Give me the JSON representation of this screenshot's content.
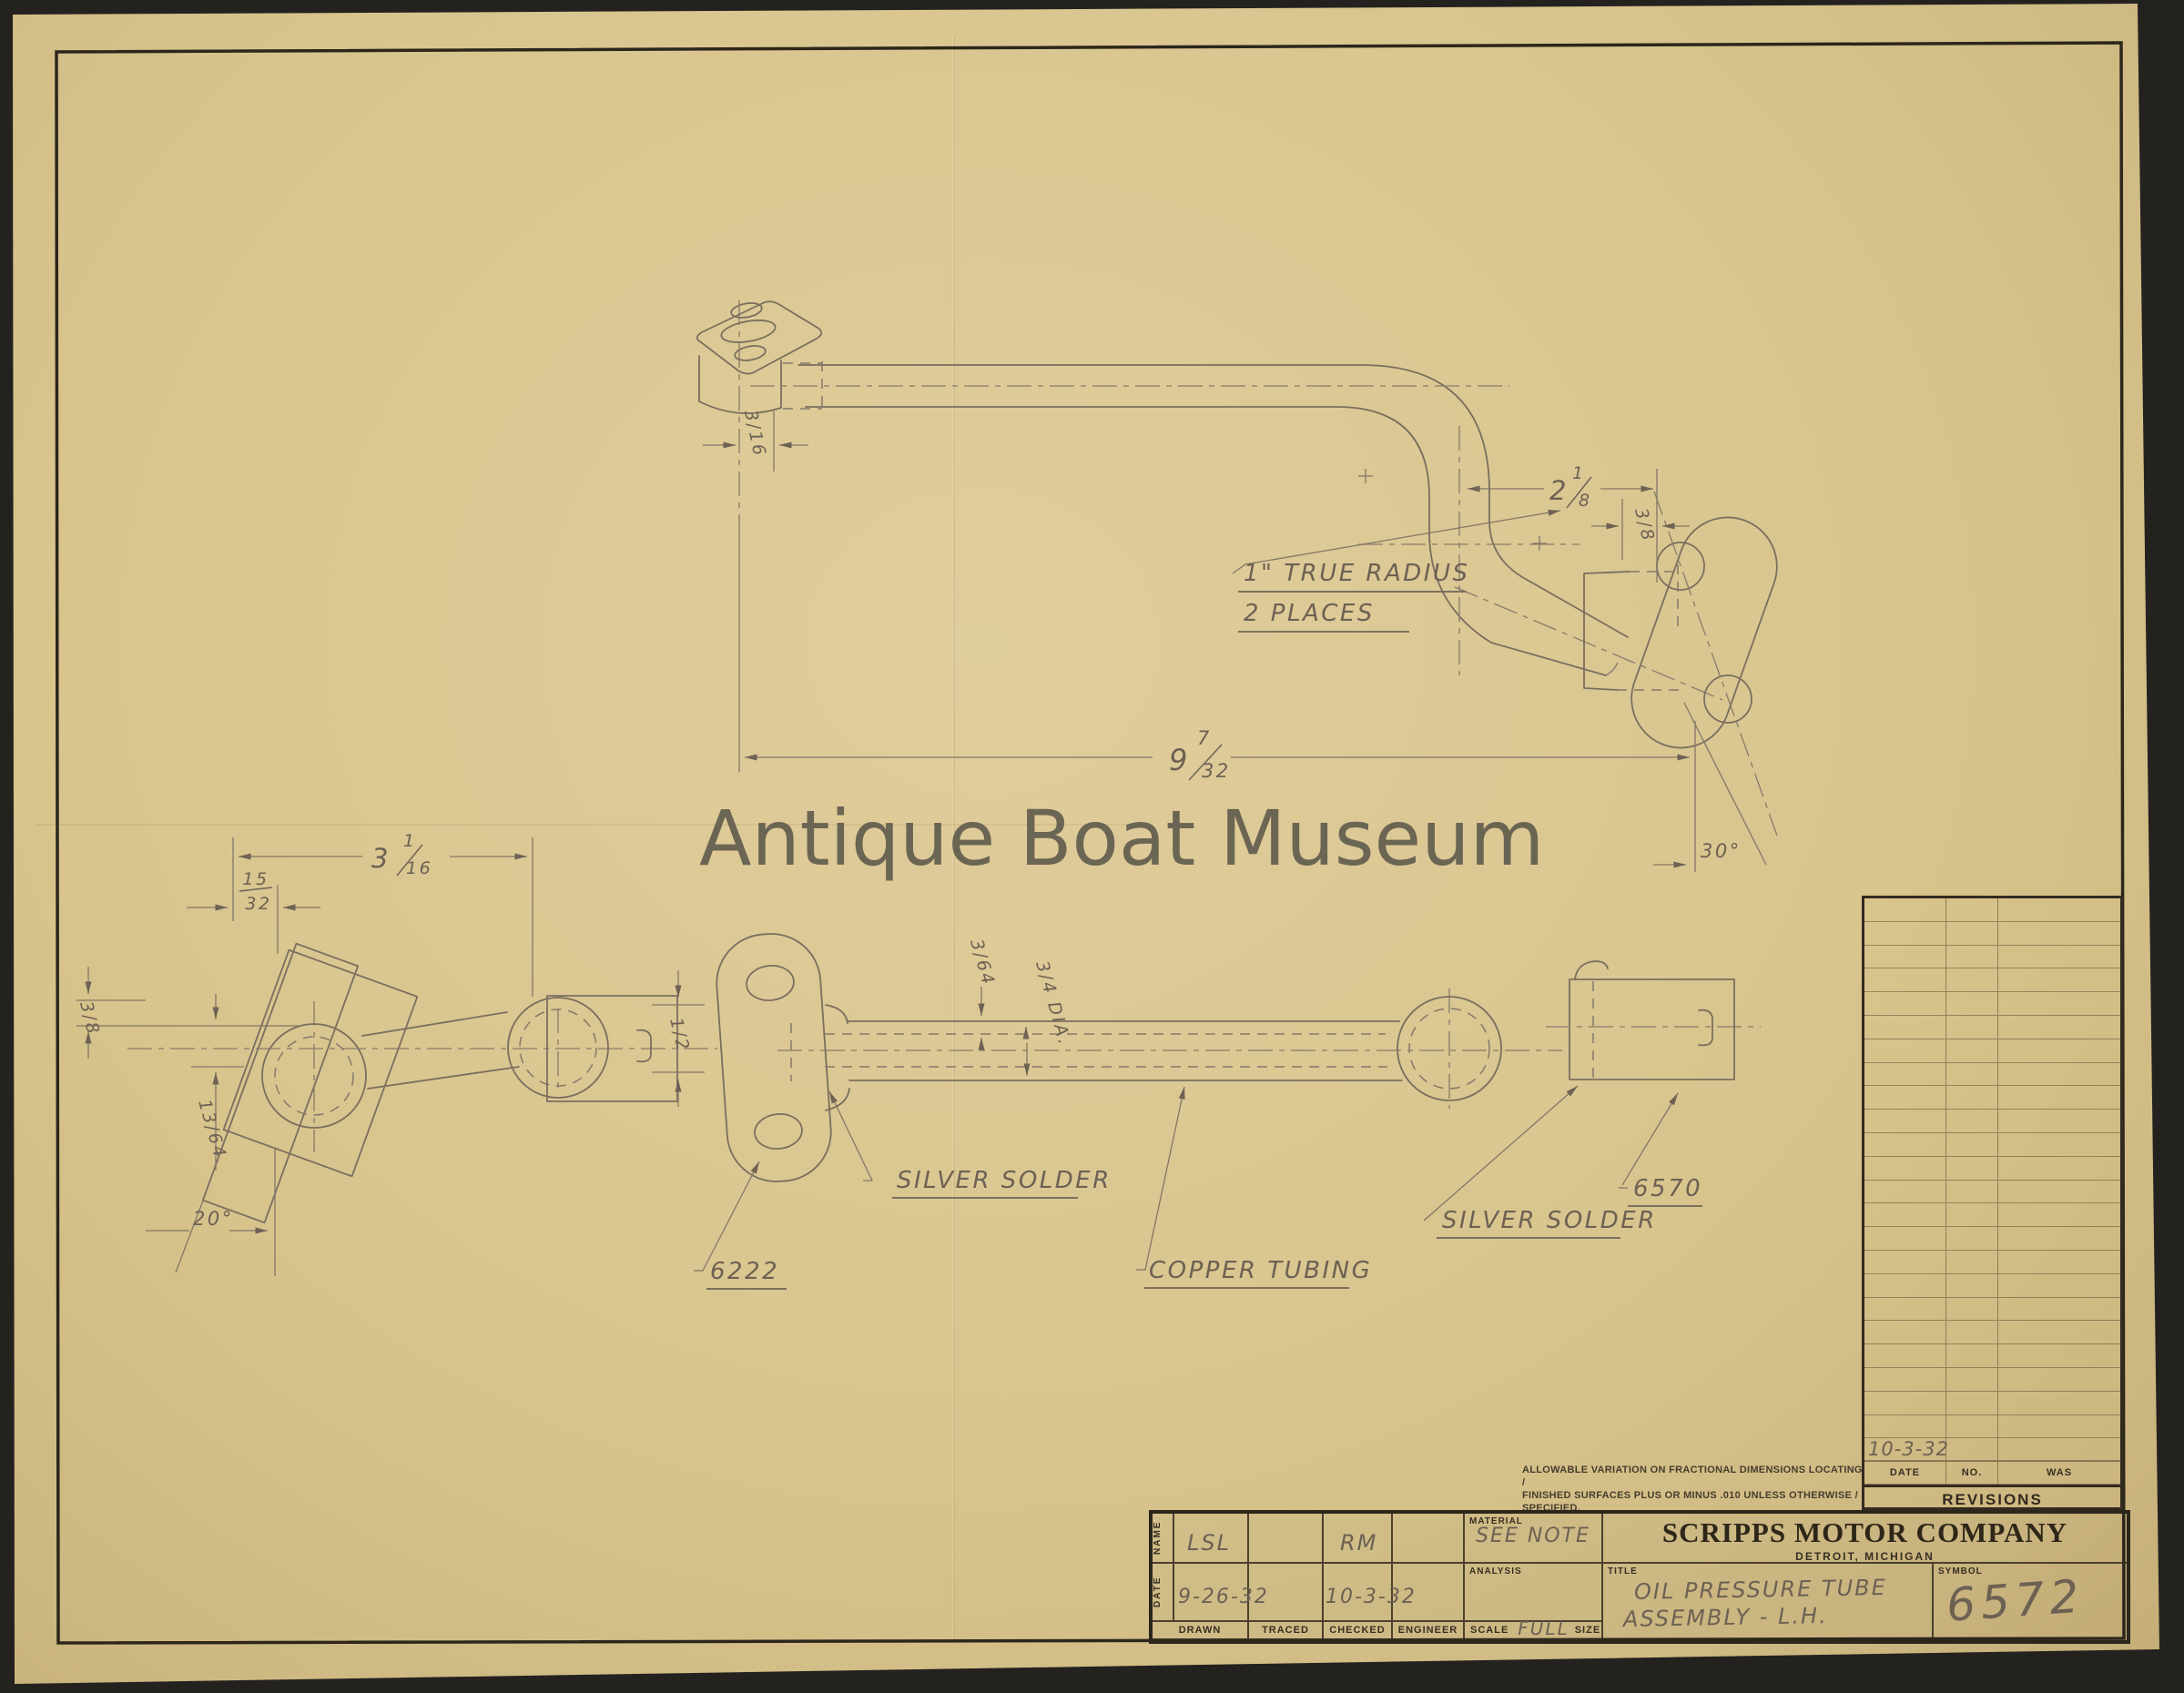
{
  "watermark": "Antique Boat Museum",
  "drawing_labels": {
    "true_radius_1": "1\" TRUE RADIUS",
    "true_radius_2": "2 PLACES",
    "silver_solder_a": "SILVER SOLDER",
    "silver_solder_b": "SILVER SOLDER",
    "copper_tubing": "COPPER TUBING",
    "part_left": "6222",
    "part_right": "6570"
  },
  "dimensions": {
    "overall": {
      "whole": "9",
      "num": "7",
      "den": "32"
    },
    "bend_offset": {
      "whole": "2",
      "num": "1",
      "den": "8"
    },
    "end_width": {
      "whole": "3",
      "num": "1",
      "den": "16"
    },
    "end_offset": {
      "num": "15",
      "den": "32"
    },
    "flange_face": "3/8",
    "port_depth": "3/16",
    "side_offset": "3/8",
    "drop": "13/64",
    "half": "1/2",
    "wall": "3/64",
    "tube_dia": "3/4 DIA.",
    "angle_flange": "20°",
    "angle_fitting": "30°"
  },
  "tolerance_note": {
    "line1": "ALLOWABLE VARIATION ON FRACTIONAL DIMENSIONS LOCATING /",
    "line2": "FINISHED SURFACES PLUS OR MINUS .010 UNLESS OTHERWISE /",
    "line3": "SPECIFIED."
  },
  "revisions": {
    "heading": "REVISIONS",
    "col_date": "DATE",
    "col_no": "NO.",
    "col_was": "WAS",
    "empty_rows": 23,
    "entry_date": "10-3-32"
  },
  "title_block": {
    "company": "SCRIPPS MOTOR COMPANY",
    "location": "DETROIT, MICHIGAN",
    "name_label": "NAME",
    "date_label": "DATE",
    "drawn_label": "DRAWN",
    "traced_label": "TRACED",
    "checked_label": "CHECKED",
    "engineer_label": "ENGINEER",
    "drawn_name": "LSL",
    "traced_name": "",
    "checked_name": "RM",
    "engineer_name": "",
    "drawn_date": "9-26-32",
    "traced_date": "",
    "checked_date": "10-3-32",
    "engineer_date": "",
    "material_label": "MATERIAL",
    "material_value": "SEE NOTE",
    "analysis_label": "ANALYSIS",
    "analysis_value": "",
    "scale_label": "SCALE",
    "scale_value": "FULL",
    "size_label": "SIZE",
    "title_label": "TITLE",
    "title_line1": "OIL PRESSURE TUBE",
    "title_line2": "ASSEMBLY - L.H.",
    "symbol_label": "SYMBOL",
    "symbol_value": "6572"
  }
}
